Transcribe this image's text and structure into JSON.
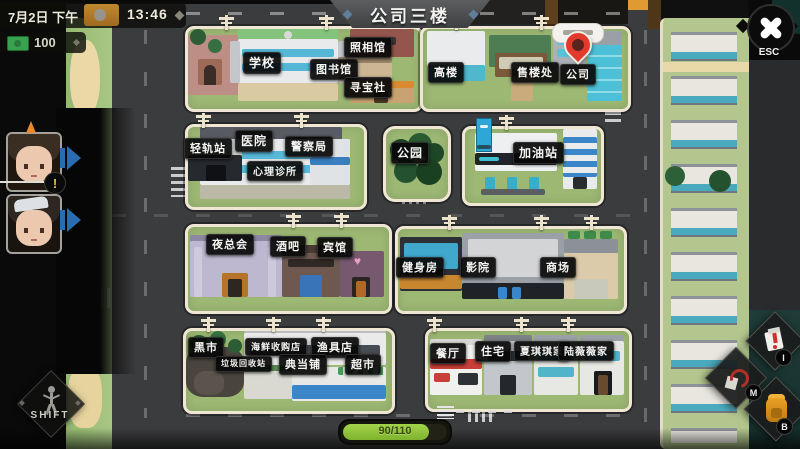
{
  "topbar": {
    "date": "7月2日 下午",
    "time": "13:46",
    "money": "100"
  },
  "banner": {
    "title": "公司三楼"
  },
  "close_button": {
    "label": "ESC"
  },
  "party": {
    "alert": "!"
  },
  "shift_button": {
    "label": "SHIFT"
  },
  "status": {
    "progress": "90/110"
  },
  "hotkeys": {
    "item": "I",
    "map": "M",
    "bag": "B"
  },
  "map": {
    "labels": [
      {
        "text": "学校"
      },
      {
        "text": "图书馆"
      },
      {
        "text": "照相馆"
      },
      {
        "text": "寻宝社"
      },
      {
        "text": "高楼"
      },
      {
        "text": "售楼处"
      },
      {
        "text": "公司"
      },
      {
        "text": "轻轨站"
      },
      {
        "text": "医院"
      },
      {
        "text": "警察局"
      },
      {
        "text": "心理诊所"
      },
      {
        "text": "公园"
      },
      {
        "text": "加油站"
      },
      {
        "text": "夜总会"
      },
      {
        "text": "酒吧"
      },
      {
        "text": "宾馆"
      },
      {
        "text": "健身房"
      },
      {
        "text": "影院"
      },
      {
        "text": "商场"
      },
      {
        "text": "黑市"
      },
      {
        "text": "海鲜收购店"
      },
      {
        "text": "渔具店"
      },
      {
        "text": "垃圾回收站"
      },
      {
        "text": "典当铺"
      },
      {
        "text": "超市"
      },
      {
        "text": "餐厅"
      },
      {
        "text": "住宅"
      },
      {
        "text": "夏琪琪家"
      },
      {
        "text": "陆薇薇家"
      }
    ]
  },
  "colors": {
    "label_bg": "#0b0b0b",
    "grass": "#9cb873",
    "sidewalk": "#efe7d3",
    "asphalt": "#3b3c3e",
    "progress_green": "#8fc43a",
    "pin_red": "#e23a2c",
    "hud_orange": "#b87c28",
    "arrow_blue": "#2a6cb0"
  }
}
